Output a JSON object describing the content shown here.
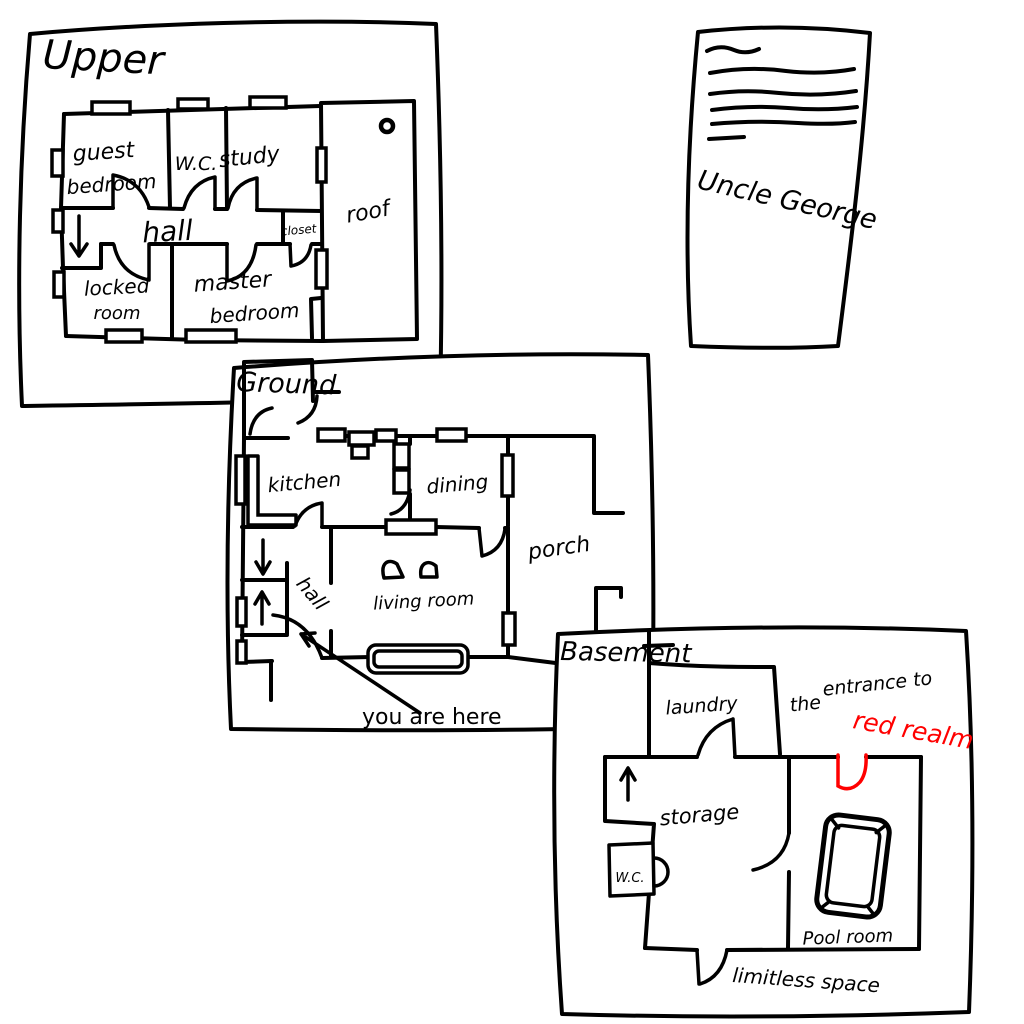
{
  "colors": {
    "ink": "#000000",
    "red_ink": "#ff0000",
    "paper": "#ffffff",
    "background": "#ffffff"
  },
  "papers": {
    "upper": {
      "label": "Upper",
      "rooms": {
        "guest_bedroom": [
          "guest",
          "bedroom"
        ],
        "wc": "W.C.",
        "study": "study",
        "hall": "hall",
        "closet": "closet",
        "roof": "roof",
        "locked_room": [
          "locked",
          "room"
        ],
        "master_bedroom": [
          "master",
          "bedroom"
        ]
      },
      "icons": [
        "stairs-down-arrow",
        "roof-vent",
        "door-arc",
        "window"
      ]
    },
    "ground": {
      "label": "Ground",
      "rooms": {
        "kitchen": "kitchen",
        "dining": "dining",
        "hall": "hall",
        "living_room": "living room",
        "porch": "porch"
      },
      "annotations": {
        "you_are_here": "you are here"
      },
      "icons": [
        "stairs-down-arrow",
        "stairs-up-arrow",
        "you-are-here-arrow",
        "front-door-arc",
        "window-seat",
        "chairs",
        "kitchen-counter"
      ]
    },
    "basement": {
      "label": "Basement",
      "rooms": {
        "laundry": "laundry",
        "storage": "storage",
        "wc": "W.C.",
        "pool_room": "Pool room"
      },
      "annotations": {
        "entrance_line1": "entrance to",
        "entrance_line2_black": "the",
        "entrance_line2_red": "red realm",
        "limitless_space": "limitless space"
      },
      "icons": [
        "stairs-up-arrow",
        "pool-table",
        "red-realm-door",
        "limitless-space-door"
      ]
    },
    "note": {
      "signature": "Uncle George",
      "icons": [
        "text-squiggles"
      ]
    }
  }
}
